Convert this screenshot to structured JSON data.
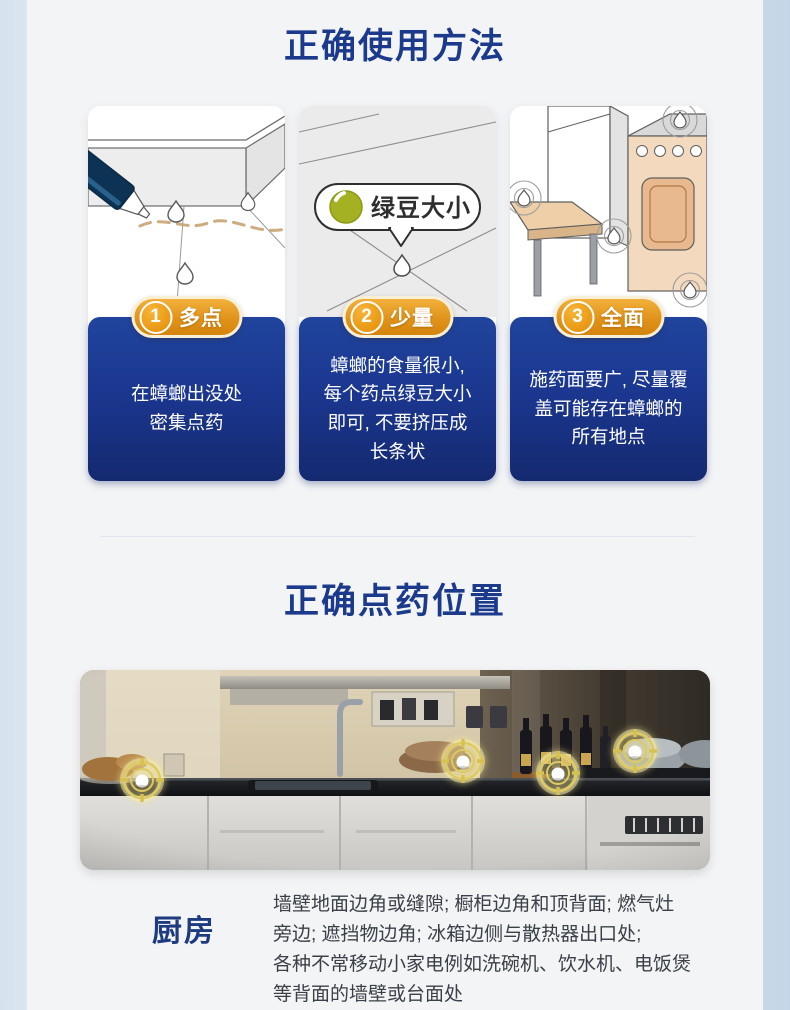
{
  "page": {
    "background": "#f3f4f6",
    "left_strip_color": "#d6e3ee",
    "right_strip_color": "#c7d8e8",
    "accent_navy": "#1c3a8c"
  },
  "usage_section": {
    "title": "正确使用方法",
    "badge_gold": "#e0931a",
    "panel_blue_top": "#20449d",
    "panel_blue_bottom": "#14296f",
    "steps": [
      {
        "num": "1",
        "label": "多点",
        "body": "在蟑螂出没处\n密集点药"
      },
      {
        "num": "2",
        "label": "少量",
        "bubble_label": "绿豆大小",
        "body": "蟑螂的食量很小,\n每个药点绿豆大小\n即可, 不要挤压成\n长条状"
      },
      {
        "num": "3",
        "label": "全面",
        "body": "施药面要广, 尽量覆\n盖可能存在蟑螂的\n所有地点"
      }
    ]
  },
  "position_section": {
    "title": "正确点药位置",
    "marker_color": "#ddca62",
    "photo_markers": [
      {
        "x": 9.8,
        "y": 55.0
      },
      {
        "x": 60.8,
        "y": 45.5
      },
      {
        "x": 75.9,
        "y": 51.5
      },
      {
        "x": 88.1,
        "y": 40.5
      }
    ],
    "location_label": "厨房",
    "location_desc": "墙壁地面边角或缝隙; 橱柜边角和顶背面; 燃气灶\n旁边; 遮挡物边角; 冰箱边侧与散热器出口处;\n各种不常移动小家电例如洗碗机、饮水机、电饭煲\n等背面的墙壁或台面处"
  }
}
